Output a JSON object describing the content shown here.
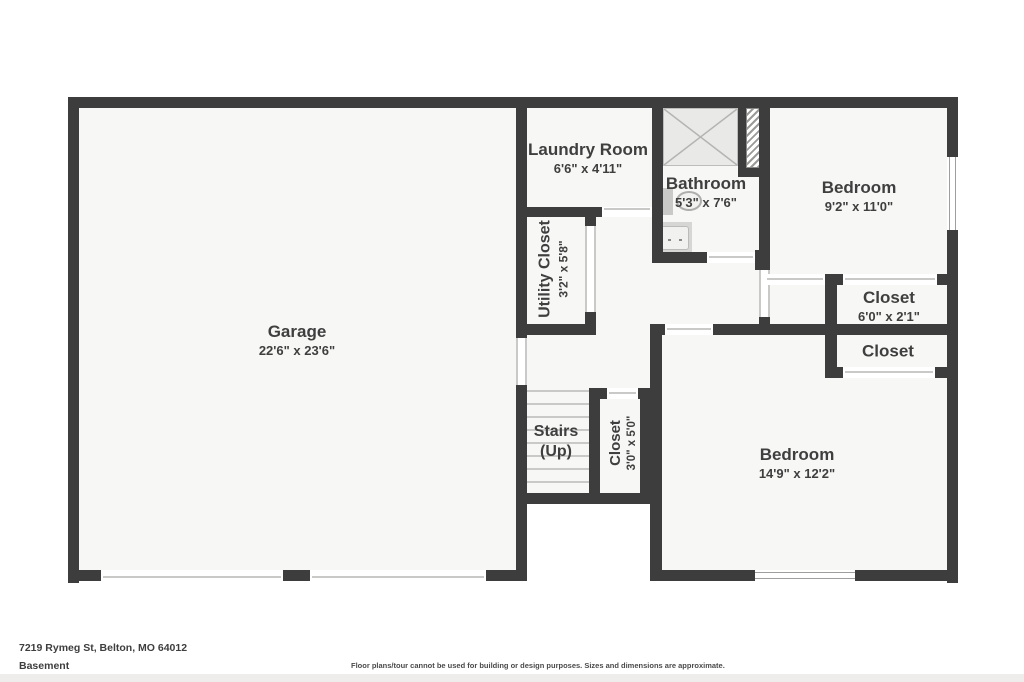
{
  "colors": {
    "wall": "#3d3d3d",
    "room_fill": "#f7f7f5",
    "shower_fill": "#e9e9e7",
    "door_line": "#c9c9c8",
    "text": "#3f3f3f"
  },
  "rooms": {
    "garage": {
      "name": "Garage",
      "dims": "22'6\" x 23'6\""
    },
    "laundry": {
      "name": "Laundry Room",
      "dims": "6'6\" x 4'11\""
    },
    "bathroom": {
      "name": "Bathroom",
      "dims": "5'3\" x 7'6\""
    },
    "bedroom1": {
      "name": "Bedroom",
      "dims": "9'2\" x 11'0\""
    },
    "closet1": {
      "name": "Closet",
      "dims": "6'0\" x 2'1\""
    },
    "closet2": {
      "name": "Closet"
    },
    "bedroom2": {
      "name": "Bedroom",
      "dims": "14'9\" x 12'2\""
    },
    "utility_closet": {
      "name": "Utility Closet",
      "dims": "3'2\" x 5'8\""
    },
    "stairs": {
      "name": "Stairs",
      "direction": "(Up)"
    },
    "closet3": {
      "name": "Closet",
      "dims": "3'0\" x 5'0\""
    }
  },
  "footer": {
    "address": "7219 Rymeg St, Belton, MO 64012",
    "floor_label": "Basement",
    "disclaimer": "Floor plans/tour cannot be used for building or design purposes. Sizes and dimensions are approximate."
  }
}
